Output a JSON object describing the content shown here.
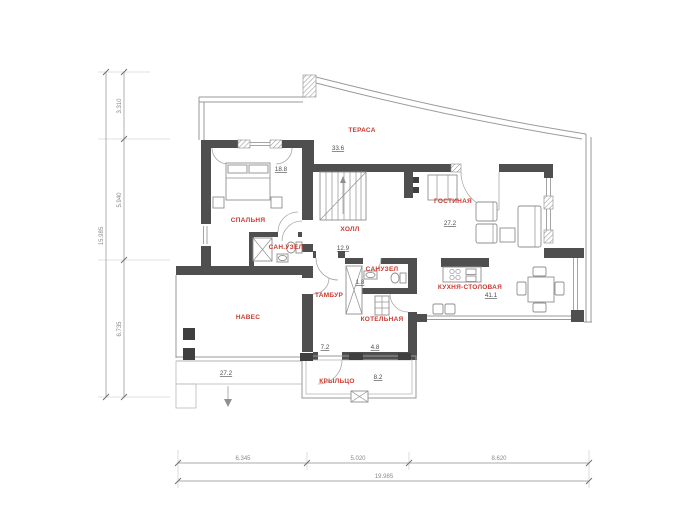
{
  "plan": {
    "type": "architectural-floor-plan",
    "floor": "first",
    "palette": {
      "room_label_color": "#ca3a31",
      "wall_color": "#4f4f4f",
      "line_color": "#9a9a9a",
      "dimension_text_color": "#8a8a8a",
      "background": "#ffffff"
    }
  },
  "rooms": {
    "terrace": {
      "label": "ТЕРАСА",
      "area": "33.6"
    },
    "bedroom": {
      "label": "СПАЛЬНЯ",
      "area": "18.8"
    },
    "hall": {
      "label": "ХОЛЛ",
      "area": "12.9"
    },
    "bathroom": {
      "label": "САН.УЗЕЛ"
    },
    "living": {
      "label": "ГОСТИНАЯ",
      "area": "27.2"
    },
    "kitchen": {
      "label": "КУХНЯ-СТОЛОВАЯ",
      "area": "41.1"
    },
    "tambour": {
      "label": "ТАМБУР",
      "area": "7.2"
    },
    "wc": {
      "label": "САНУЗЕЛ",
      "area": "1.8"
    },
    "boiler": {
      "label": "КОТЕЛЬНАЯ",
      "area": "4.8"
    },
    "carport": {
      "label": "НАВЕС",
      "area": "27.2"
    },
    "porch": {
      "label": "КРЫЛЬЦО",
      "area": "8.2"
    }
  },
  "dimensions": {
    "left": {
      "total": "15.985",
      "segments": [
        "3.310",
        "5.940",
        "6.735"
      ]
    },
    "bottom": {
      "total": "19.985",
      "segments": [
        "6.345",
        "5.020",
        "8.620"
      ]
    }
  }
}
